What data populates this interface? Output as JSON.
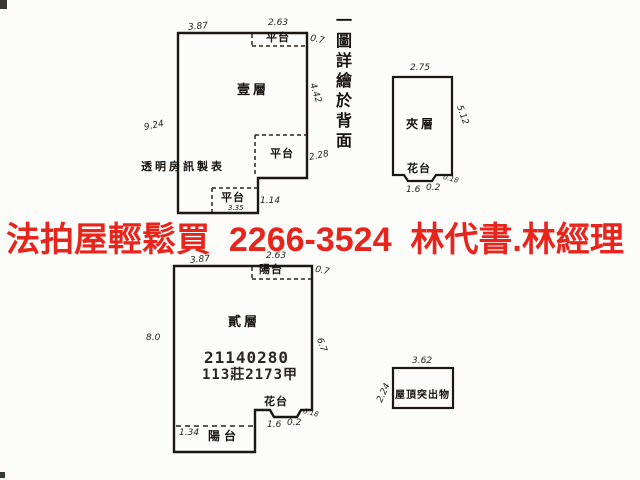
{
  "banner": {
    "text": "法拍屋輕鬆買  2266-3524  林代書.林經理",
    "color": "#e8251c"
  },
  "side_note": {
    "text": "一圖詳繪於背面"
  },
  "first_floor": {
    "room_label": "壹層",
    "dim_top_left": "3.87",
    "dim_top_right": "2.63",
    "platform_top": "平台",
    "dim_right_upper": "0.7",
    "dim_right": "4.42",
    "dim_left": "9.24",
    "platform_mid": "平台",
    "dim_platform_mid": "2.28",
    "maker_note": "透明房訊製表",
    "platform_bottom": "平台",
    "dim_platform_bottom_width": "3.35",
    "dim_platform_bottom_height": "1.14"
  },
  "mezzanine": {
    "room_label": "夾層",
    "dim_top": "2.75",
    "dim_right": "5.12",
    "flower_bed": "花台",
    "dim_flower_left": "1.6",
    "dim_flower_mid": "0.2",
    "dim_flower_right": "0.18"
  },
  "second_floor": {
    "room_label": "貳層",
    "dim_top_left": "3.87",
    "dim_top_right": "2.63",
    "balcony_top": "陽台",
    "dim_right_upper": "0.7",
    "dim_right": "6.7",
    "dim_left": "8.0",
    "stamp_number": "21140280",
    "case_number": "113莊2173甲",
    "flower_bed": "花台",
    "dim_flower_left": "1.6",
    "dim_flower_mid": "0.2",
    "dim_flower_right": "0.18",
    "balcony_bottom": "陽台",
    "dim_balcony_height": "1.34"
  },
  "roof": {
    "label": "屋頂突出物",
    "dim_top": "3.62",
    "dim_left": "2.24"
  },
  "colors": {
    "ink": "#1b1713",
    "paper": "#fcfcfa",
    "banner_red": "#e8251c"
  }
}
